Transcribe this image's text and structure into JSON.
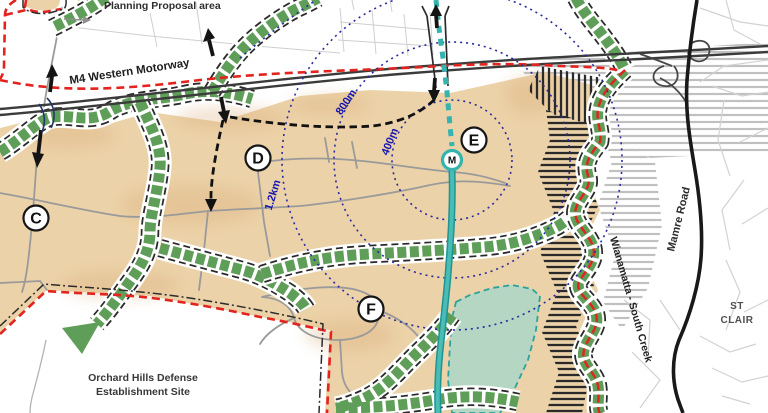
{
  "map": {
    "title_note": "Planning proposal structure map",
    "region_labels": {
      "planning_proposal": "Planning Proposal area",
      "m4_motorway": "M4 Western Motorway",
      "mamre_road": "Mamre Road",
      "wianamatta": "Wianamatta - South Creek",
      "st_clair_line1": "ST",
      "st_clair_line2": "CLAIR",
      "orchard_line1": "Orchard Hills Defense",
      "orchard_line2": "Establishment Site"
    },
    "radius_labels": {
      "r400": "400m",
      "r800": "800m",
      "r1200": "1.2km"
    },
    "radii_px": {
      "r400": 60,
      "r800": 118,
      "r1200": 170
    },
    "precincts": [
      {
        "label": "C"
      },
      {
        "label": "D"
      },
      {
        "label": "E"
      },
      {
        "label": "F"
      }
    ],
    "station": {
      "label": "M"
    },
    "colors": {
      "tan": "#ecd2a8",
      "tan_shade": "#d8ac79",
      "corridor_green": "#5f9e58",
      "teal": "#35b3af",
      "creek_dark": "#1f9490",
      "riparian_fill": "#b5d6c3",
      "boundary_red": "#e3231e",
      "radius_blue": "#2a2aa0",
      "label_blue": "#1515b2",
      "road_gray": "#9a9a9a",
      "motorway_dark": "#3b3b3b",
      "mamre_black": "#191919",
      "hatch_gray": "#c0c0c0",
      "hatch_black": "#2a2a2a"
    }
  }
}
